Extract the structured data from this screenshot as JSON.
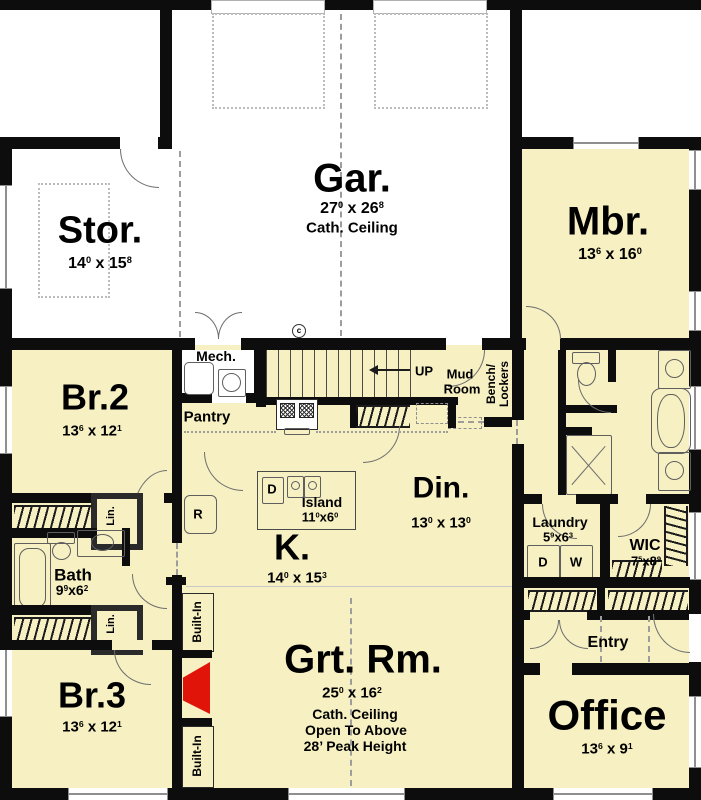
{
  "colors": {
    "wall": "#0d0d0d",
    "room_fill": "#f6f0c2",
    "exterior_fill": "#ffffff",
    "fireplace_red": "#e01408"
  },
  "rooms": {
    "stor": {
      "name": "Stor.",
      "dim": "14^0^ x 15^8^"
    },
    "gar": {
      "name": "Gar.",
      "dim": "27^0^ x 26^8^",
      "note": "Cath. Ceiling"
    },
    "mbr": {
      "name": "Mbr.",
      "dim": "13^6^ x 16^0^"
    },
    "br2": {
      "name": "Br.2",
      "dim": "13^6^ x 12^1^"
    },
    "br3": {
      "name": "Br.3",
      "dim": "13^6^ x 12^1^"
    },
    "bath": {
      "name": "Bath",
      "dim": "9^9^x6^2^"
    },
    "kitchen": {
      "name": "K.",
      "dim": "14^0^ x 15^3^"
    },
    "island": {
      "name": "Island",
      "dim": "11^0^x6^0^"
    },
    "dining": {
      "name": "Din.",
      "dim": "13^0^ x 13^0^"
    },
    "great_room": {
      "name": "Grt. Rm.",
      "dim": "25^0^ x 16^2^",
      "notes": [
        "Cath. Ceiling",
        "Open To Above",
        "28’ Peak Height"
      ]
    },
    "laundry": {
      "name": "Laundry",
      "dim": "5^9^x6^3^"
    },
    "wic": {
      "name": "WIC",
      "dim": "7^5^x8^9^"
    },
    "office": {
      "name": "Office",
      "dim": "13^6^ x 9^1^"
    },
    "mud_room": {
      "name_line1": "Mud",
      "name_line2": "Room"
    },
    "mech": {
      "name": "Mech."
    },
    "pantry": {
      "name": "Pantry"
    },
    "entry": {
      "name": "Entry"
    }
  },
  "labels": {
    "up": "UP",
    "bench_line1": "Bench/",
    "bench_line2": "Lockers",
    "linen": "Lin.",
    "built_in": "Built-In",
    "washer": "W",
    "dryer": "D",
    "refrigerator": "R",
    "dishwasher": "D",
    "keynote_c": "c"
  }
}
